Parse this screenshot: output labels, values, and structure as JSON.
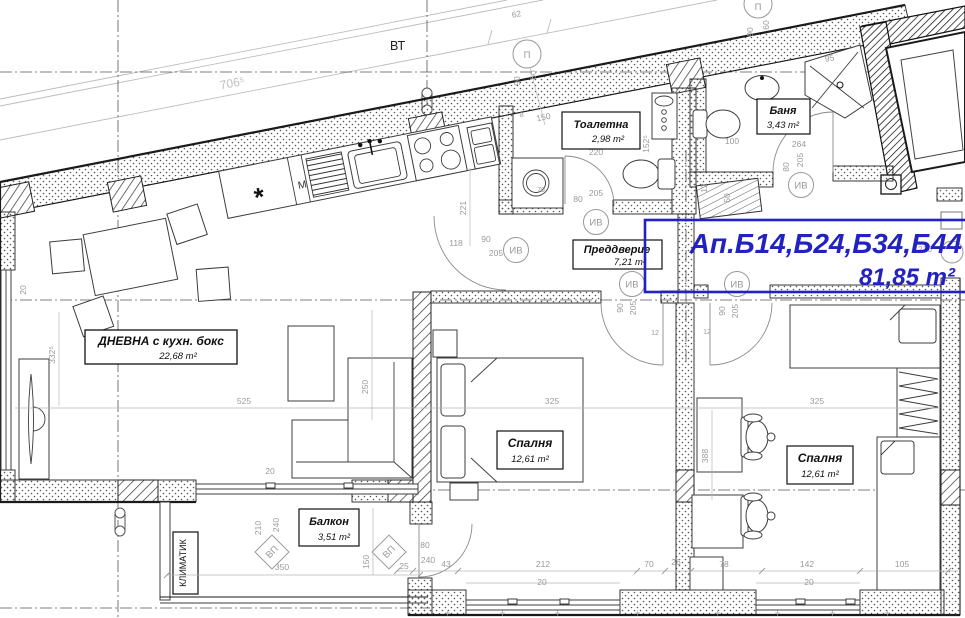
{
  "title_block": {
    "apartments": "Ап.Б14,Б24,Б34,Б44",
    "total_area": "81,85 m²",
    "accent_color": "#2222c2"
  },
  "rooms": {
    "toilet": {
      "name": "Тоалетна",
      "area": "2,98 m²"
    },
    "bath": {
      "name": "Баня",
      "area": "3,43 m²"
    },
    "vestibule": {
      "name": "Преддверие",
      "area": "7,21 m²"
    },
    "living": {
      "name": "ДНЕВНА с кухн. бокс",
      "area": "22,68 m²"
    },
    "bedroom1": {
      "name": "Спалня",
      "area": "12,61 m²"
    },
    "bedroom2": {
      "name": "Спалня",
      "area": "12,61 m²"
    },
    "balcony": {
      "name": "Балкон",
      "area": "3,51 m²"
    }
  },
  "annotations": {
    "vt": "ВТ",
    "klimatik": "КЛИМАТИК",
    "washer": "М",
    "star": "*"
  },
  "axis_markers": {
    "p": "П",
    "iv": "ИВ",
    "vp": "ВП"
  },
  "dims": {
    "d01": "62",
    "d02": "706⁵",
    "d03": "150",
    "d04": "8",
    "d05": "220",
    "d06": "90",
    "d07": "60",
    "d08": "100",
    "d09": "264",
    "d10": "80",
    "d11": "205",
    "d12": "95",
    "d13": "90",
    "d14": "60",
    "d15": "152⁵",
    "d16": "12",
    "d17": "50",
    "d18": "70",
    "d19": "221",
    "d20": "118",
    "d21": "90",
    "d22": "205",
    "d23": "80",
    "d24": "205",
    "d25": "90",
    "d26": "205",
    "d27": "90",
    "d28": "205",
    "d29": "12",
    "d30": "12",
    "d31": "525",
    "d32": "325",
    "d33": "325",
    "d34": "332⁵",
    "d35": "250",
    "d36": "388",
    "d37": "20",
    "d38": "20",
    "d39": "210",
    "d40": "240",
    "d41": "350",
    "d42": "150",
    "d43": "25",
    "d44": "80",
    "d45": "240",
    "d46": "43",
    "d47": "212",
    "d48": "20",
    "d49": "70",
    "d50": "26",
    "d51": "78",
    "d52": "142",
    "d53": "105",
    "d54": "20",
    "d55": "210"
  }
}
